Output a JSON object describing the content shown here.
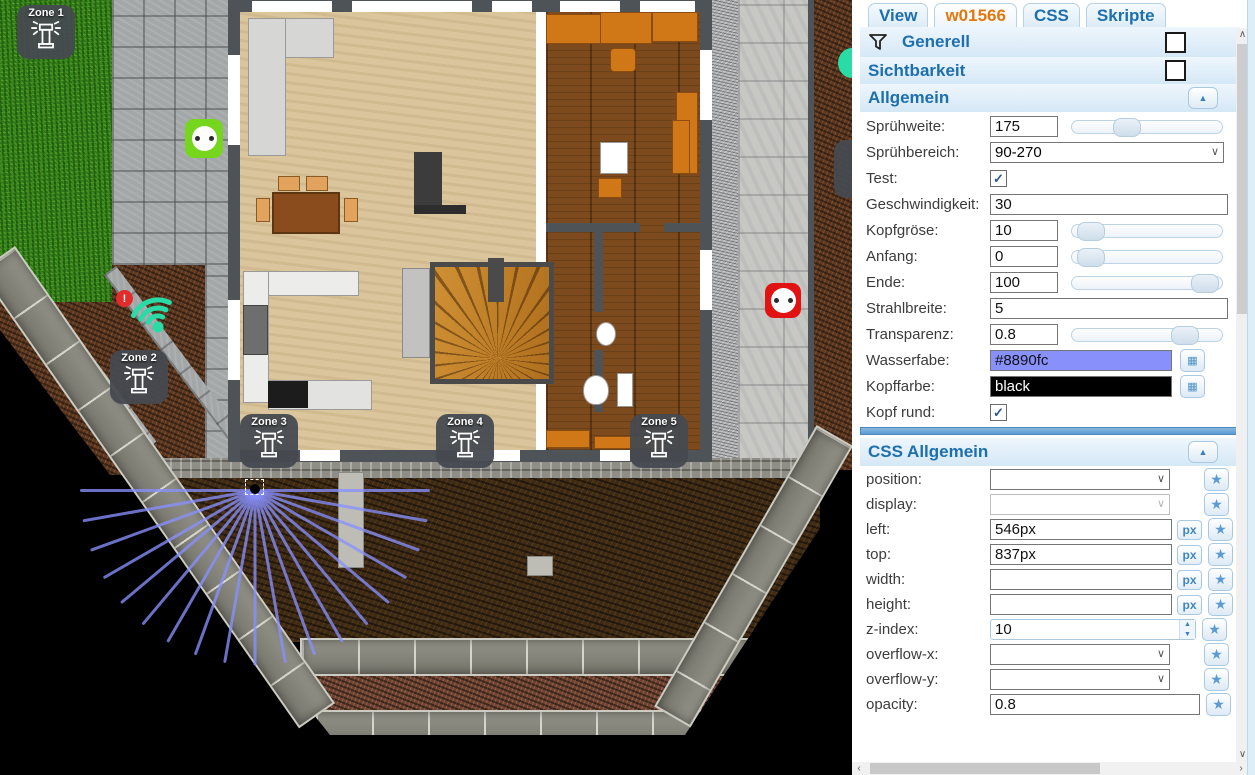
{
  "tabs": {
    "items": [
      {
        "label": "View",
        "active": false
      },
      {
        "label": "w01566",
        "active": true
      },
      {
        "label": "CSS",
        "active": false
      },
      {
        "label": "Skripte",
        "active": false
      }
    ]
  },
  "panel": {
    "generell_label": "Generell",
    "sichtbarkeit_label": "Sichtbarkeit",
    "allgemein_title": "Allgemein",
    "css_title": "CSS Allgemein",
    "collapse_icon": "▲",
    "star_icon": "★",
    "px_unit": "px",
    "fields": {
      "spruehweite": {
        "label": "Sprühweite:",
        "value": "175",
        "slider_pct": 33
      },
      "spruehbereich": {
        "label": "Sprühbereich:",
        "value": "90-270"
      },
      "test": {
        "label": "Test:",
        "checked": true
      },
      "geschwindigkeit": {
        "label": "Geschwindigkeit:",
        "value": "30"
      },
      "kopfgroese": {
        "label": "Kopfgröse:",
        "value": "10",
        "slider_pct": 4
      },
      "anfang": {
        "label": "Anfang:",
        "value": "0",
        "slider_pct": 4
      },
      "ende": {
        "label": "Ende:",
        "value": "100",
        "slider_pct": 97
      },
      "strahlbreite": {
        "label": "Strahlbreite:",
        "value": "5"
      },
      "transparenz": {
        "label": "Transparenz:",
        "value": "0.8",
        "slider_pct": 81
      },
      "wasserfarbe": {
        "label": "Wasserfabe:",
        "value": "#8890fc",
        "color": "#8890fc"
      },
      "kopffarbe": {
        "label": "Kopffarbe:",
        "value": "black",
        "color": "#000000"
      },
      "kopfrund": {
        "label": "Kopf rund:",
        "checked": true
      }
    },
    "css_fields": {
      "position": {
        "label": "position:",
        "value": ""
      },
      "display": {
        "label": "display:",
        "value": ""
      },
      "left": {
        "label": "left:",
        "value": "546px"
      },
      "top": {
        "label": "top:",
        "value": "837px"
      },
      "width": {
        "label": "width:",
        "value": ""
      },
      "height": {
        "label": "height:",
        "value": ""
      },
      "zindex": {
        "label": "z-index:",
        "value": "10"
      },
      "overflowx": {
        "label": "overflow-x:",
        "value": ""
      },
      "overflowy": {
        "label": "overflow-y:",
        "value": ""
      },
      "opacity": {
        "label": "opacity:",
        "value": "0.8"
      }
    }
  },
  "floorplan": {
    "zones": [
      {
        "label": "Zone 1"
      },
      {
        "label": "Zone 2"
      },
      {
        "label": "Zone 3"
      },
      {
        "label": "Zone 4"
      },
      {
        "label": "Zone 5"
      }
    ],
    "wifi_alert": "!",
    "wifi_color": "#29dca6",
    "spray": {
      "color": "#8890fc",
      "head_color": "black",
      "ray_count": 19,
      "start_deg": 0,
      "end_deg": 180,
      "length_px": 175,
      "opacity": 0.78
    }
  }
}
